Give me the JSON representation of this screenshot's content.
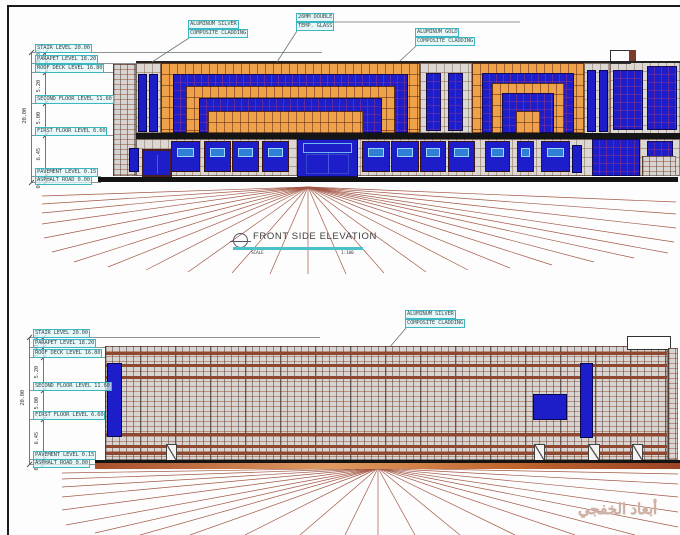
{
  "drawing": {
    "title": "FRONT SIDE ELEVATION",
    "scale_label": "SCALE",
    "scale_value": "1:100",
    "watermark": "أبعاد الخفجي"
  },
  "levels": [
    {
      "label": "STAIR LEVEL 20.00"
    },
    {
      "label": "PARAPET LEVEL 18.20"
    },
    {
      "label": "ROOF DECK LEVEL 16.80"
    },
    {
      "label": "SECOND FLOOR LEVEL 11.60"
    },
    {
      "label": "FIRST FLOOR LEVEL 6.60"
    },
    {
      "label": "PAVEMENT LEVEL 0.15"
    },
    {
      "label": "ASPHALT ROAD 0.00"
    }
  ],
  "dimensions": {
    "overall": "20.00",
    "segments": [
      "1.80",
      "1.40",
      "5.20",
      "5.00",
      "6.45",
      "0.15"
    ]
  },
  "callouts": {
    "silver_top": {
      "line1": "ALUMINUM SILVER",
      "line2": "COMPOSITE CLADDING"
    },
    "glass": {
      "line1": "26MM DOUBLE",
      "line2": "TEMP. GLASS"
    },
    "gold": {
      "line1": "ALUMINUM GOLD",
      "line2": "COMPOSITE CLADDING"
    },
    "silver_bottom": {
      "line1": "ALUMINUM SILVER",
      "line2": "COMPOSITE CLADDING"
    }
  },
  "colors": {
    "cladding_gold": "#f0a24b",
    "cladding_silver": "#dbd7d2",
    "glass_blue": "#1d1dc9",
    "door_slot_blue": "#2f7fd6",
    "callout_teal": "#3cb6c0",
    "perspective_line": "#9a4632",
    "ground_line": "#141414"
  }
}
